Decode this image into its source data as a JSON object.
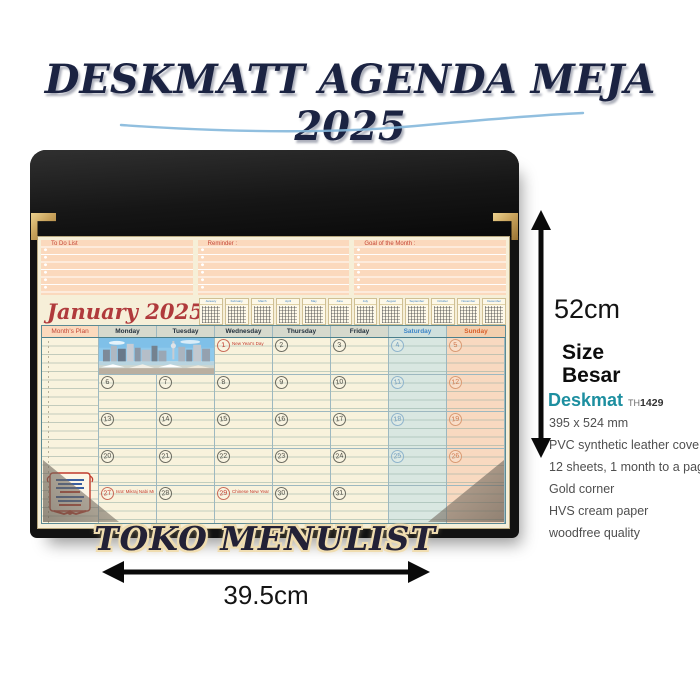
{
  "title": {
    "text": "DESKMATT AGENDA MEJA 2025"
  },
  "calendar": {
    "top_panels": [
      {
        "label": "To Do List"
      },
      {
        "label": "Reminder :"
      },
      {
        "label": "Goal of the Month :"
      }
    ],
    "month_title": "January 2025",
    "mini_months": [
      "January",
      "February",
      "March",
      "April",
      "May",
      "June",
      "July",
      "August",
      "September",
      "October",
      "November",
      "December"
    ],
    "plan_header": "Month's Plan",
    "day_headers": [
      {
        "label": "Monday",
        "type": "weekday"
      },
      {
        "label": "Tuesday",
        "type": "weekday"
      },
      {
        "label": "Wednesday",
        "type": "weekday"
      },
      {
        "label": "Thursday",
        "type": "weekday"
      },
      {
        "label": "Friday",
        "type": "weekday"
      },
      {
        "label": "Saturday",
        "type": "saturday"
      },
      {
        "label": "Sunday",
        "type": "sunday"
      }
    ],
    "weeks": [
      {
        "cells": [
          {
            "photo": true
          },
          {
            "day": "1",
            "red": true,
            "holiday": "New Year's Day"
          },
          {
            "day": "2"
          },
          {
            "day": "3"
          },
          {
            "day": "4"
          },
          {
            "day": "5"
          }
        ]
      },
      {
        "cells": [
          {
            "day": "6"
          },
          {
            "day": "7"
          },
          {
            "day": "8"
          },
          {
            "day": "9"
          },
          {
            "day": "10"
          },
          {
            "day": "11"
          },
          {
            "day": "12"
          }
        ]
      },
      {
        "cells": [
          {
            "day": "13"
          },
          {
            "day": "14"
          },
          {
            "day": "15"
          },
          {
            "day": "16"
          },
          {
            "day": "17"
          },
          {
            "day": "18"
          },
          {
            "day": "19"
          }
        ]
      },
      {
        "cells": [
          {
            "day": "20"
          },
          {
            "day": "21"
          },
          {
            "day": "22"
          },
          {
            "day": "23"
          },
          {
            "day": "24"
          },
          {
            "day": "25"
          },
          {
            "day": "26"
          }
        ]
      },
      {
        "cells": [
          {
            "day": "27",
            "red": true,
            "holiday": "Isra' Mikraj Nabi Muhammad SAW"
          },
          {
            "day": "28"
          },
          {
            "day": "29",
            "red": true,
            "holiday": "Chinese New Year"
          },
          {
            "day": "30"
          },
          {
            "day": "31"
          },
          {
            "day": ""
          },
          {
            "day": ""
          }
        ]
      }
    ]
  },
  "dimensions": {
    "height_label": "52cm",
    "width_label": "39.5cm"
  },
  "specs": {
    "size_line1": "Size",
    "size_line2": "Besar",
    "brand": "Deskmat",
    "model_prefix": "TH",
    "model_number": "1429",
    "lines": [
      "395 x 524 mm",
      "PVC synthetic leather cover",
      "12 sheets, 1 month to a page",
      "Gold corner",
      "HVS cream paper",
      "woodfree quality"
    ]
  },
  "footer": {
    "store_name": "TOKO MENULIST"
  },
  "icons": {
    "height_arrow": "double-arrow-vertical",
    "width_arrow": "double-arrow-horizontal"
  },
  "colors": {
    "title_navy": "#1b2342",
    "swoosh_blue": "#85b8dc",
    "mat_black": "#121212",
    "paper_cream": "#f6efd8",
    "panel_peach": "#fbd9bd",
    "holiday_red": "#c23b2e",
    "month_red": "#b03a3c",
    "brand_teal": "#1d8fa0",
    "gold": "#c9a35c"
  }
}
